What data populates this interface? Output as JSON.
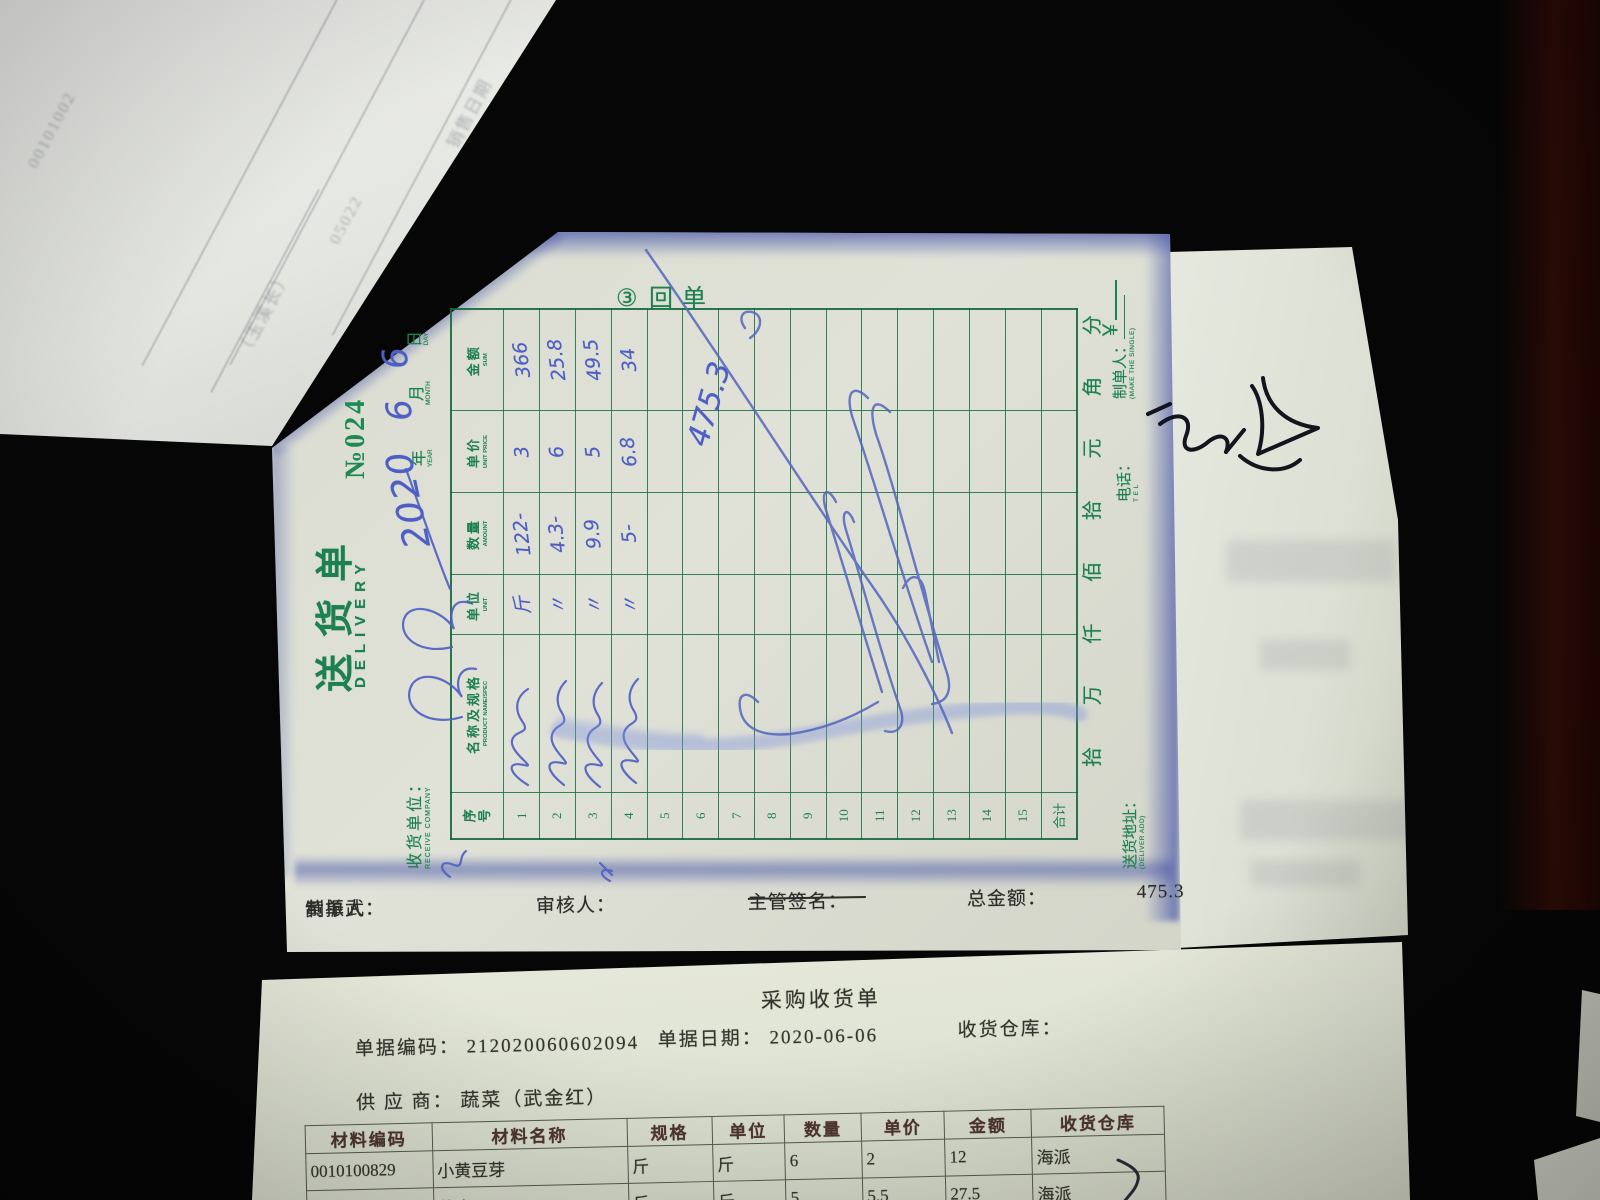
{
  "delivery_note": {
    "copy_stamp_chars": [
      "③",
      "回",
      "单"
    ],
    "title_cn": "送货单",
    "title_en": "DELIVERY",
    "no_label": "№",
    "no_value": "024",
    "receive_company_label": "收货单位：",
    "receive_company_en": "RECEIVE COMPANY",
    "receive_company_handwritten": "(illegible cursive name)",
    "date": {
      "year": "2020",
      "year_label": "年",
      "year_en": "YEAR",
      "month": "6",
      "month_label": "月",
      "month_en": "MONTH",
      "day": "6",
      "day_label": "日",
      "day_en": "DAY"
    },
    "table": {
      "headers": [
        {
          "cn": "序号",
          "en": ""
        },
        {
          "cn": "名称及规格",
          "en": "PRODUCT NAME/SPEC"
        },
        {
          "cn": "单位",
          "en": "UNIT"
        },
        {
          "cn": "数量",
          "en": "AMOUNT"
        },
        {
          "cn": "单价",
          "en": "UNIT PRICE"
        },
        {
          "cn": "金额",
          "en": "SUM"
        }
      ],
      "rows": [
        {
          "no": "1",
          "name": "(illegible)",
          "unit": "斤",
          "qty": "122-",
          "price": "3",
          "sum": "366"
        },
        {
          "no": "2",
          "name": "(illegible)",
          "unit": "〃",
          "qty": "4.3-",
          "price": "6",
          "sum": "25.8"
        },
        {
          "no": "3",
          "name": "(illegible)",
          "unit": "〃",
          "qty": "9.9",
          "price": "5",
          "sum": "49.5"
        },
        {
          "no": "4",
          "name": "(illegible)",
          "unit": "〃",
          "qty": "5-",
          "price": "6.8",
          "sum": "34"
        },
        {
          "no": "5"
        },
        {
          "no": "6"
        },
        {
          "no": "7"
        },
        {
          "no": "8"
        },
        {
          "no": "9"
        },
        {
          "no": "10"
        },
        {
          "no": "11"
        },
        {
          "no": "12"
        },
        {
          "no": "13"
        },
        {
          "no": "14"
        },
        {
          "no": "15"
        },
        {
          "no": "合计"
        }
      ],
      "total_handwritten": "475.3"
    },
    "amount_words_chars": [
      "拾",
      "万",
      "仟",
      "佰",
      "拾",
      "元",
      "角",
      "分"
    ],
    "currency_symbol": "￥",
    "deliver_add_label": "送货地址：",
    "deliver_add_en": "(DELIVER ADD)",
    "tel_label": "电话：",
    "tel_en": "T E L",
    "maker_label": "制单人：",
    "maker_en": "(MAKE THE SINGLE)",
    "footer": {
      "maker_label": "制单人：",
      "maker_name": "黄振武",
      "auditor_label": "审核人：",
      "manager_sign_label": "主管签名：",
      "total_label": "总金额：",
      "total_value": "475.3"
    }
  },
  "receipt_doc": {
    "title": "采购收货单",
    "doc_no_label": "单据编码：",
    "doc_no": "212020060602094",
    "doc_date_label": "单据日期：",
    "doc_date": "2020-06-06",
    "warehouse_label": "收货仓库：",
    "supplier_label": "供 应 商：",
    "supplier": "蔬菜（武金红）",
    "table": {
      "headers": [
        "材料编码",
        "材料名称",
        "规格",
        "单位",
        "数量",
        "单价",
        "金额",
        "收货仓库"
      ],
      "rows": [
        [
          "0010100829",
          "小黄豆芽",
          "斤",
          "斤",
          "6",
          "2",
          "12",
          "海派"
        ],
        [
          "001010083",
          "蒜肉",
          "斤",
          "斤",
          "5",
          "5.5",
          "27.5",
          "海派"
        ]
      ]
    }
  },
  "ghost_sheet": {
    "lines": [
      "00101002",
      "销售日期",
      "（玉溪长）",
      "05022"
    ]
  },
  "colors": {
    "form_green": "#1d8050",
    "handwriting_blue": "#4d5fc4",
    "paper_cream": "#dfe1d7"
  }
}
